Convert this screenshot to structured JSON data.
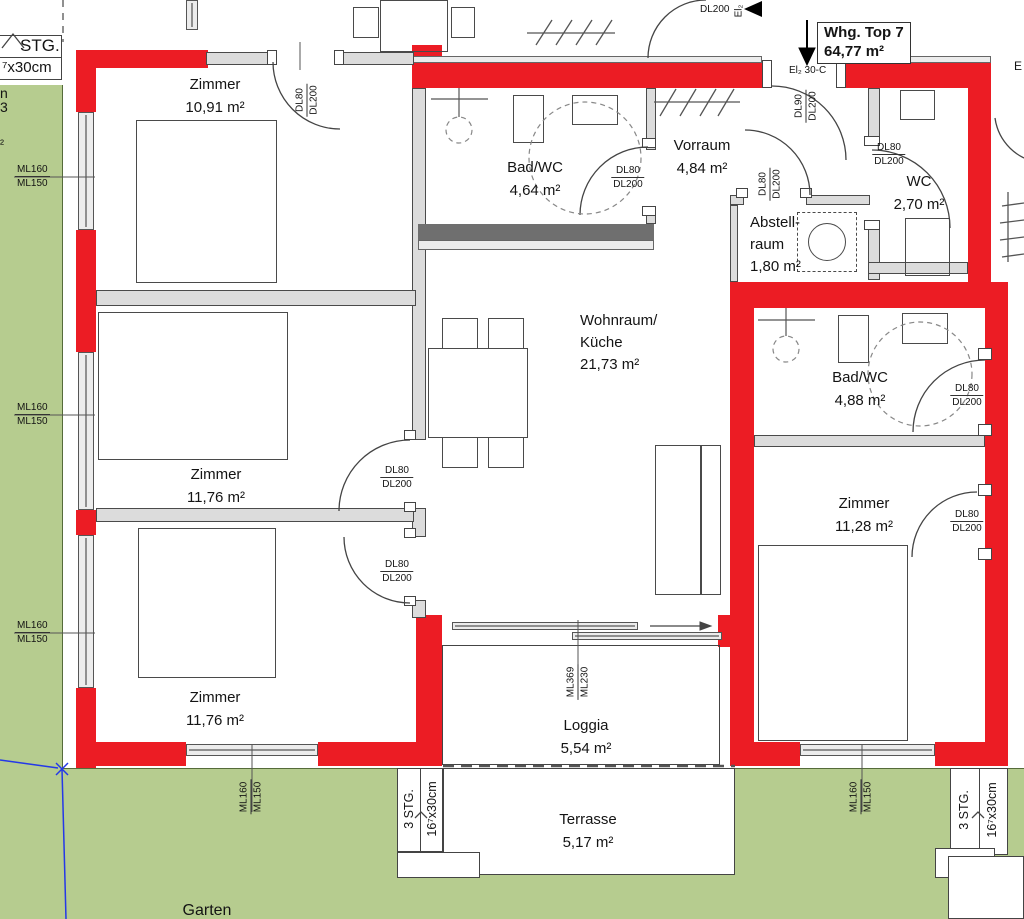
{
  "title": {
    "name": "Whg. Top 7",
    "area": "64,77 m²"
  },
  "rooms": {
    "zimmer_top_left": {
      "name": "Zimmer",
      "area": "10,91 m²"
    },
    "zimmer_mid_left": {
      "name": "Zimmer",
      "area": "11,76 m²"
    },
    "zimmer_bottom_left": {
      "name": "Zimmer",
      "area": "11,76 m²"
    },
    "bad_wc_top": {
      "name": "Bad/WC",
      "area": "4,64 m²"
    },
    "vorraum": {
      "name": "Vorraum",
      "area": "4,84 m²"
    },
    "abstellraum": {
      "line1": "Abstell-",
      "line2": "raum",
      "area": "1,80 m²"
    },
    "wc": {
      "name": "WC",
      "area": "2,70 m²"
    },
    "wohnraum": {
      "line1": "Wohnraum/",
      "line2": "Küche",
      "area": "21,73 m²"
    },
    "bad_wc_right": {
      "name": "Bad/WC",
      "area": "4,88 m²"
    },
    "zimmer_right": {
      "name": "Zimmer",
      "area": "11,28 m²"
    },
    "loggia": {
      "name": "Loggia",
      "area": "5,54 m²"
    },
    "terrasse": {
      "name": "Terrasse",
      "area": "5,17 m²"
    },
    "garten": {
      "name": "Garten"
    }
  },
  "door_labels": {
    "dl80": "DL80",
    "dl90": "DL90",
    "dl200": "DL200"
  },
  "window_labels": {
    "ml160": "ML160",
    "ml150": "ML150",
    "ml369": "ML369",
    "ml230": "ML230"
  },
  "stairs": {
    "steps": "3 STG.",
    "step_size": "16⁷x30cm",
    "top_left_partial": "STG.",
    "top_left_size": "⁷x30cm"
  },
  "entrance": {
    "unit_door": "El₂ 30-C",
    "corridor_door": "DL200",
    "corridor_el": "El₂"
  },
  "edge_partials": {
    "left_1": "n",
    "left_2": "3",
    "left_3": "²",
    "right_1": "E"
  },
  "colors": {
    "wall_red": "#ec1c24",
    "garden_green": "#b6cc8f",
    "interior_gray": "#dcdcdc",
    "line": "#3d3d3d",
    "boundary_blue": "#2438e8"
  }
}
